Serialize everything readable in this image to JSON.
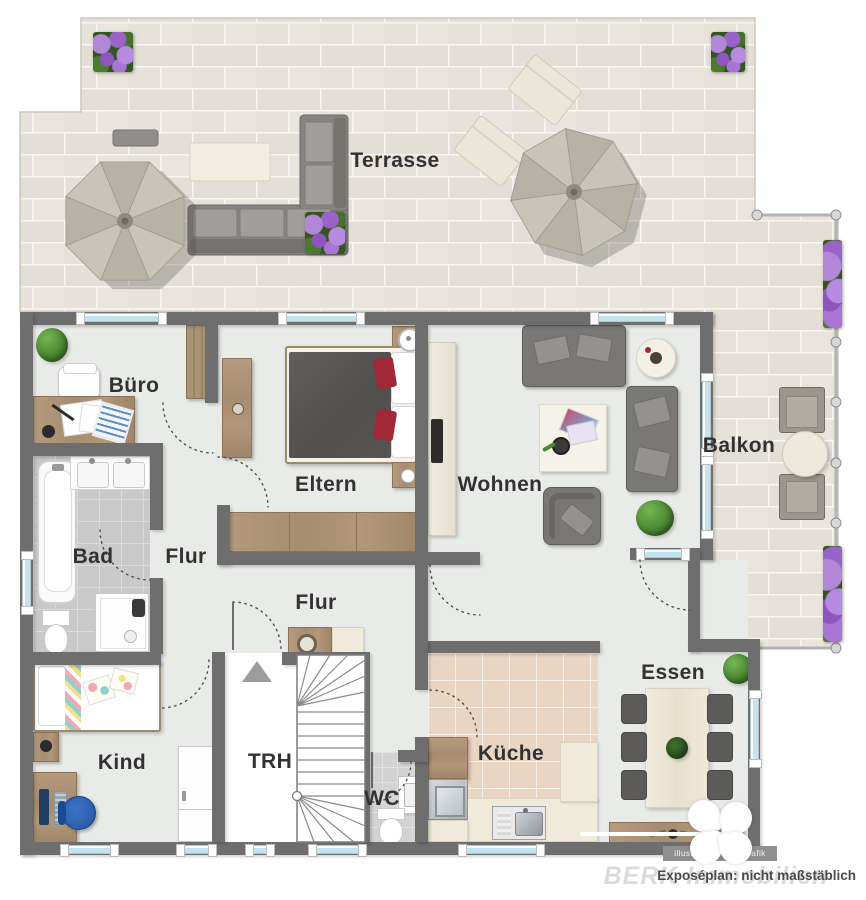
{
  "labels": {
    "terrasse": "Terrasse",
    "buero": "Büro",
    "eltern": "Eltern",
    "wohnen": "Wohnen",
    "balkon": "Balkon",
    "bad": "Bad",
    "flur_upper": "Flur",
    "flur_lower": "Flur",
    "kind": "Kind",
    "trh": "TRH",
    "wc": "WC",
    "kueche": "Küche",
    "essen": "Essen"
  },
  "watermarks": {
    "credit": "illustration ImmoGrafik",
    "scale_note": "Exposéplan: nicht maßstäblich",
    "brand": "BERK Immobilien"
  },
  "colors": {
    "wall": "#6e6e6e",
    "floor": "#e9ebe8",
    "terrace_tile": "#e7e2d9",
    "bath_tile": "#c9c9c9",
    "kitchen_tile": "#ead5c3",
    "window_glass": "#c3e4ef",
    "wood": "#ab916f",
    "sofa_gray": "#7a7876",
    "accent_red": "#a22737",
    "plant_green": "#4c8a33",
    "flower_purple": "#a06cc8"
  }
}
